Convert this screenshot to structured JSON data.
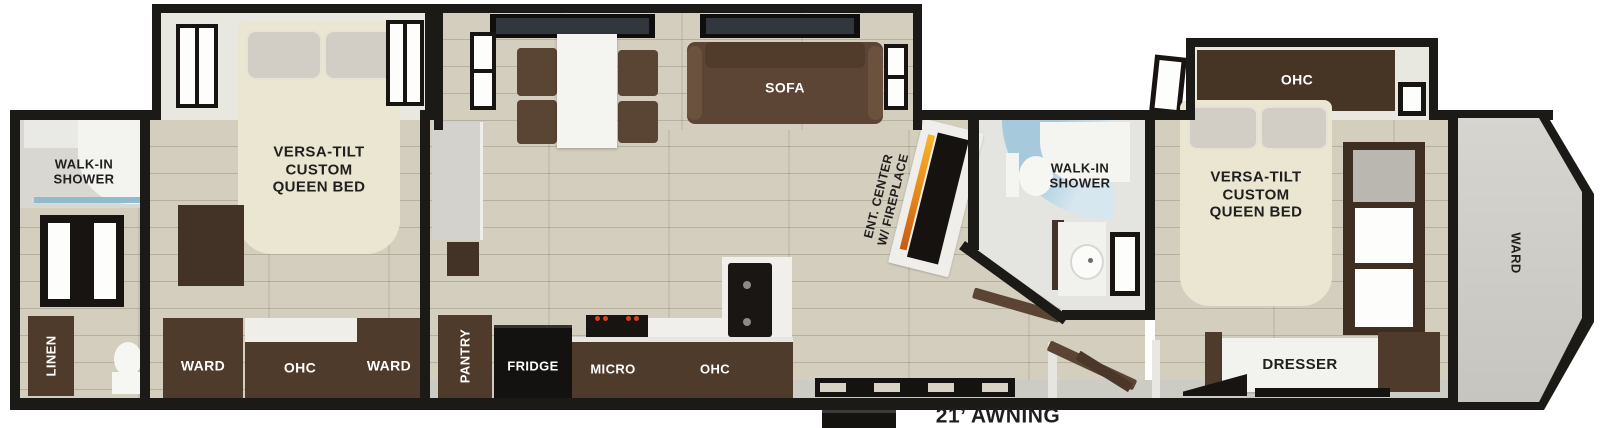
{
  "exterior": {
    "awning_label": "21’ AWNING"
  },
  "rear_bath": {
    "shower_label": "WALK-IN\nSHOWER",
    "linen_label": "LINEN"
  },
  "bedroom2": {
    "bed_label": "VERSA-TILT\nCUSTOM\nQUEEN BED",
    "ward_left_label": "WARD",
    "ohc_label": "OHC",
    "ward_right_label": "WARD"
  },
  "living": {
    "sofa_label": "SOFA",
    "ent_center_label": "ENT. CENTER\nW/ FIREPLACE"
  },
  "kitchen": {
    "pantry_label": "PANTRY",
    "fridge_label": "FRIDGE",
    "micro_label": "MICRO",
    "ohc_label": "OHC"
  },
  "mid_bath": {
    "shower_label": "WALK-IN\nSHOWER"
  },
  "front_bedroom": {
    "ohc_label": "OHC",
    "bed_label": "VERSA-TILT\nCUSTOM\nQUEEN BED",
    "dresser_label": "DRESSER",
    "ward_label": "WARD"
  },
  "colors": {
    "wall_black": "#1c1a17",
    "floor_tan": "#d4cebf",
    "cabinet_brown": "#4f3b2b",
    "bed_cream": "#eae6d1",
    "sofa_brown": "#5c4534",
    "shower_glass_blue": "#a6c9dc",
    "fireplace_flame_orange": "#e8881a",
    "appliance_black": "#171412",
    "label_dark": "#201f1d",
    "label_light": "#ffffff"
  }
}
